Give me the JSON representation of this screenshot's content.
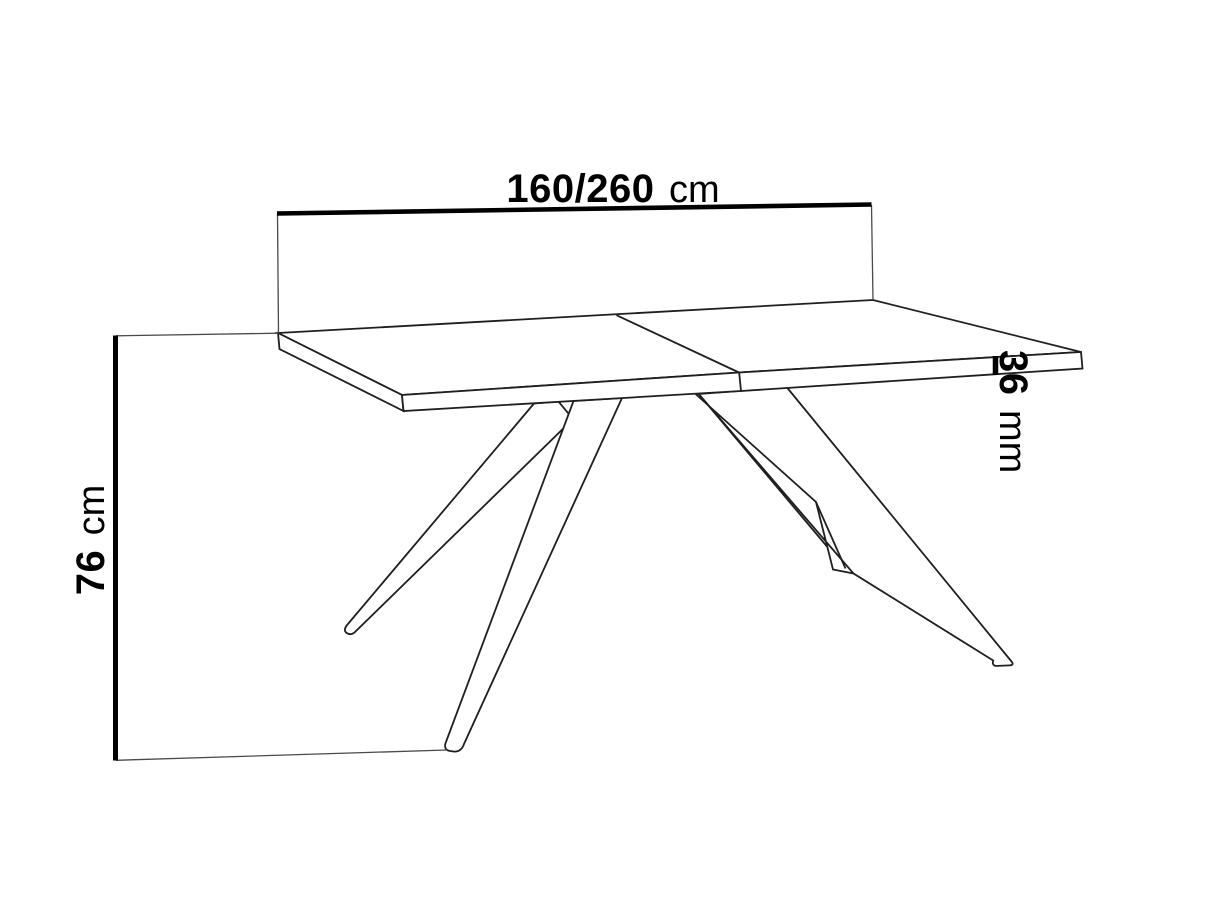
{
  "colors": {
    "background": "#ffffff",
    "line": "#1f1f1f",
    "dimension": "#000000",
    "extension": "#4a4a4a"
  },
  "dimensions": {
    "width": {
      "value": "160/260",
      "unit": "cm"
    },
    "height": {
      "value": "76",
      "unit": "cm"
    },
    "thickness": {
      "value": "36",
      "unit": "mm"
    }
  }
}
